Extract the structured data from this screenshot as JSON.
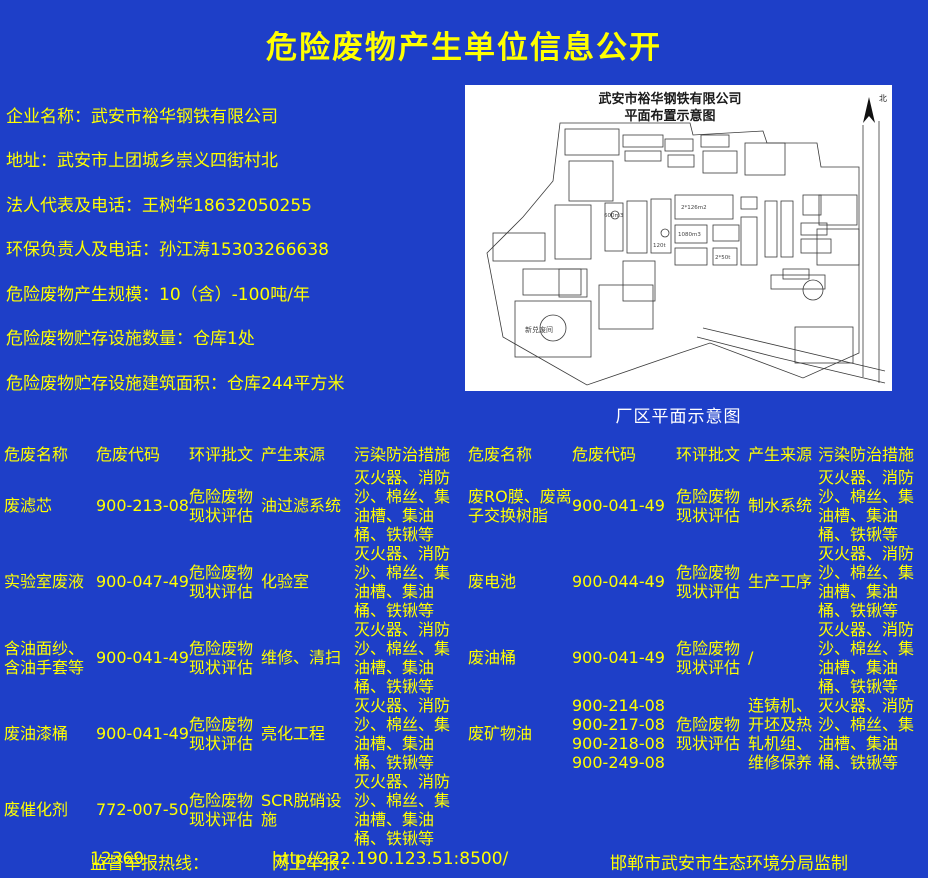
{
  "colors": {
    "background": "#1e3fc8",
    "text_yellow": "#ffff00",
    "caption_white": "#ffffff",
    "map_background": "#ffffff",
    "map_line": "#3a3a3a"
  },
  "page": {
    "title": "危险废物产生单位信息公开"
  },
  "info": {
    "items": [
      {
        "label": "企业名称：",
        "value": "武安市裕华钢铁有限公司"
      },
      {
        "label": "地址：",
        "value": "武安市上团城乡崇义四街村北"
      },
      {
        "label": "法人代表及电话：",
        "value": "王树华18632050255"
      },
      {
        "label": "环保负责人及电话：",
        "value": "孙江涛15303266638"
      },
      {
        "label": "危险废物产生规模：",
        "value": "10（含）-100吨/年"
      },
      {
        "label": "危险废物贮存设施数量：",
        "value": "仓库1处"
      },
      {
        "label": "危险废物贮存设施建筑面积：",
        "value": "仓库244平方米"
      }
    ]
  },
  "map": {
    "title_line1": "武安市裕华钢铁有限公司",
    "title_line2": "平面布置示意图",
    "north_label": "北",
    "caption": "厂区平面示意图",
    "annotations": [
      "600m3",
      "1080m3",
      "120t",
      "2*50t",
      "2*126m2",
      "新兑废间"
    ]
  },
  "tables": {
    "headers": [
      "危废名称",
      "危废代码",
      "环评批文",
      "产生来源",
      "污染防治措施"
    ],
    "left_rows": [
      {
        "name": "废滤芯",
        "code": "900-213-08",
        "approval": "危险废物现状评估",
        "source": "油过滤系统",
        "measures": "灭火器、消防沙、棉丝、集油槽、集油桶、铁锹等"
      },
      {
        "name": "实验室废液",
        "code": "900-047-49",
        "approval": "危险废物现状评估",
        "source": "化验室",
        "measures": "灭火器、消防沙、棉丝、集油槽、集油桶、铁锹等"
      },
      {
        "name": "含油面纱、含油手套等",
        "code": "900-041-49",
        "approval": "危险废物现状评估",
        "source": "维修、清扫",
        "measures": "灭火器、消防沙、棉丝、集油槽、集油桶、铁锹等"
      },
      {
        "name": "废油漆桶",
        "code": "900-041-49",
        "approval": "危险废物现状评估",
        "source": "亮化工程",
        "measures": "灭火器、消防沙、棉丝、集油槽、集油桶、铁锹等"
      },
      {
        "name": "废催化剂",
        "code": "772-007-50",
        "approval": "危险废物现状评估",
        "source": "SCR脱硝设施",
        "measures": "灭火器、消防沙、棉丝、集油槽、集油桶、铁锹等"
      }
    ],
    "right_rows": [
      {
        "name": "废RO膜、废离子交换树脂",
        "code": "900-041-49",
        "approval": "危险废物现状评估",
        "source": "制水系统",
        "measures": "灭火器、消防沙、棉丝、集油槽、集油桶、铁锹等"
      },
      {
        "name": "废电池",
        "code": "900-044-49",
        "approval": "危险废物现状评估",
        "source": "生产工序",
        "measures": "灭火器、消防沙、棉丝、集油槽、集油桶、铁锹等"
      },
      {
        "name": "废油桶",
        "code": "900-041-49",
        "approval": "危险废物现状评估",
        "source": "/",
        "measures": "灭火器、消防沙、棉丝、集油槽、集油桶、铁锹等"
      },
      {
        "name": "废矿物油",
        "code": "900-214-08\n900-217-08\n900-218-08\n900-249-08",
        "approval": "危险废物现状评估",
        "source": "连铸机、开坯及热轧机组、维修保养",
        "measures": "灭火器、消防沙、棉丝、集油槽、集油桶、铁锹等"
      }
    ]
  },
  "footer": {
    "hotline_label": "监督举报热线：",
    "hotline_value": "12369",
    "online_label": "网上举报：",
    "online_value": "http//222.190.123.51:8500/",
    "producer": "邯郸市武安市生态环境分局监制"
  }
}
